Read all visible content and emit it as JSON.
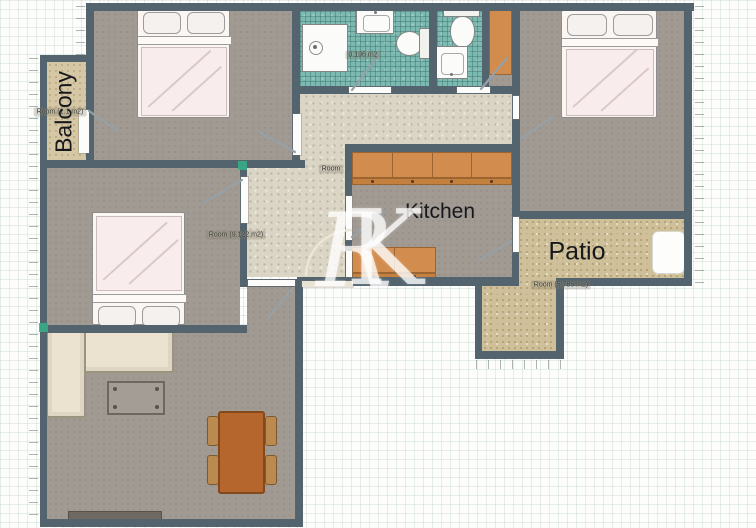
{
  "watermark": {
    "r": "R",
    "k": "K"
  },
  "rooms": {
    "balcony": {
      "name": "Balcony",
      "area": "Room (1.1 m2)"
    },
    "kitchen": {
      "name": "Kitchen"
    },
    "patio": {
      "name": "Patio",
      "area": "Room (5.785 m2)"
    },
    "bedroom_left": {
      "area": "Room (9.122 m2)"
    },
    "hallway": {
      "area": "Room"
    },
    "bathroom_main": {
      "area": "0.196 m2"
    }
  },
  "colors": {
    "wall": "#53646e",
    "floor": "#a19a92",
    "hallway": "#dbd5c5",
    "patio-floor": "#cfc099",
    "balcony-floor": "#d5c6a4",
    "tile": "#7cb9b0",
    "cabinet": "#d28d4e",
    "table": "#b4662c",
    "chair": "#bb8a50",
    "sofa": "#ebe3d0",
    "bed": "#f8ecec",
    "accent-green": "#35b08a"
  }
}
